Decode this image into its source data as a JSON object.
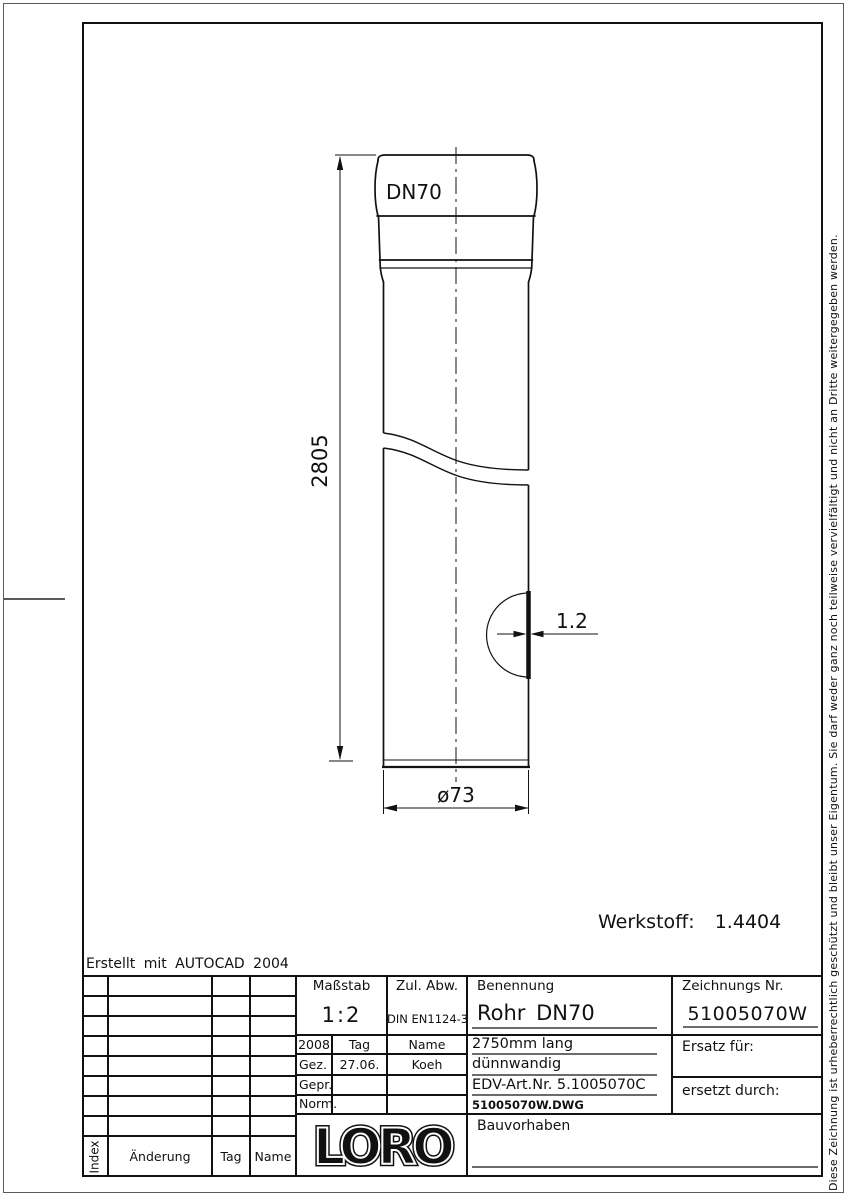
{
  "sheet": {
    "erstellt": "Erstellt mit AUTOCAD 2004",
    "werkstoff": "Werkstoff:  1.4404",
    "copyright": "Diese Zeichnung ist urheberrechtlich geschützt und bleibt unser Eigentum. Sie darf weder ganz noch teilweise vervielfältigt und nicht an Dritte weitergegeben werden."
  },
  "drawing": {
    "dn_label": "DN70",
    "length_dim": "2805",
    "wall_dim": "1.2",
    "dia_dim": "ø73"
  },
  "title_block": {
    "masstab_label": "Maßstab",
    "masstab_value": "1:2",
    "zul_abw_label": "Zul. Abw.",
    "zul_abw_value": "DIN EN1124-3",
    "benennung_label": "Benennung",
    "benennung_value": "Rohr DN70",
    "detail_line1": "2750mm lang",
    "detail_line2": "dünnwandig",
    "detail_line3": "EDV-Art.Nr. 5.1005070C",
    "detail_line4": "51005070W.DWG",
    "zeichnungs_nr_label": "Zeichnungs Nr.",
    "zeichnungs_nr_value": "51005070W",
    "ersatz_label": "Ersatz für:",
    "ersetzt_label": "ersetzt durch:",
    "bauvorhaben_label": "Bauvorhaben",
    "logo": "LORO",
    "approval": {
      "year": "2008",
      "tag_header": "Tag",
      "name_header": "Name",
      "gez_label": "Gez.",
      "gez_tag": "27.06.",
      "gez_name": "Koeh",
      "gepr_label": "Gepr.",
      "norm_label": "Norm."
    },
    "revision": {
      "index_label": "Index",
      "aenderung_label": "Änderung",
      "tag_label": "Tag",
      "name_label": "Name"
    }
  },
  "colors": {
    "line": "#111111",
    "gray_line": "#6b6b6b",
    "background": "#ffffff"
  }
}
